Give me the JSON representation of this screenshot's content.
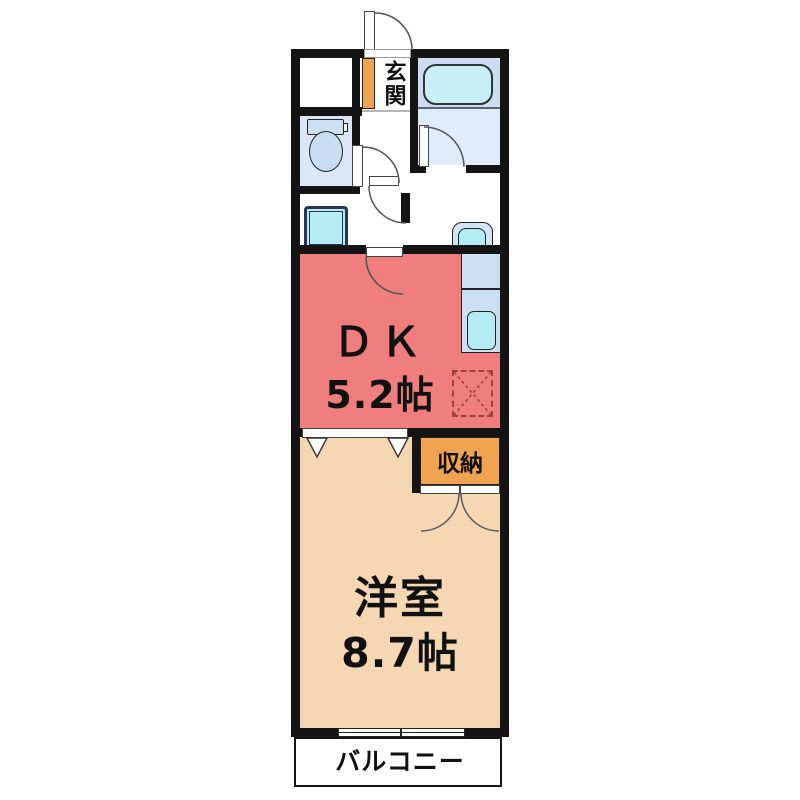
{
  "floorplan": {
    "type": "apartment-1DK-madori",
    "rooms": {
      "entrance": {
        "label": "玄関"
      },
      "dining_kitchen": {
        "name": "ＤＫ",
        "size": "5.2帖"
      },
      "western_room": {
        "name": "洋室",
        "size": "8.7帖"
      },
      "storage": {
        "label": "収納"
      },
      "balcony": {
        "label": "バルコニー"
      }
    },
    "fixtures": [
      "bathtub",
      "toilet",
      "washing-machine-pan",
      "wash-basin",
      "kitchen-sink",
      "refrigerator-space"
    ],
    "colors": {
      "wall": "#141414",
      "dk_fill": "#f07e7e",
      "western_room_fill": "#f5d7b4",
      "storage_fill": "#f0a350",
      "entrance_cabinet_fill": "#f0a350",
      "bathroom_fill": "#d4e4f6",
      "toilet_room_fill": "#dbe7f8",
      "water_fixture_cyan": "#b4ecf5",
      "kitchen_counter_fill": "#cbdff5",
      "balcony_fill": "#e3e0e0",
      "refrigerator_dash": "#9c4040"
    }
  }
}
